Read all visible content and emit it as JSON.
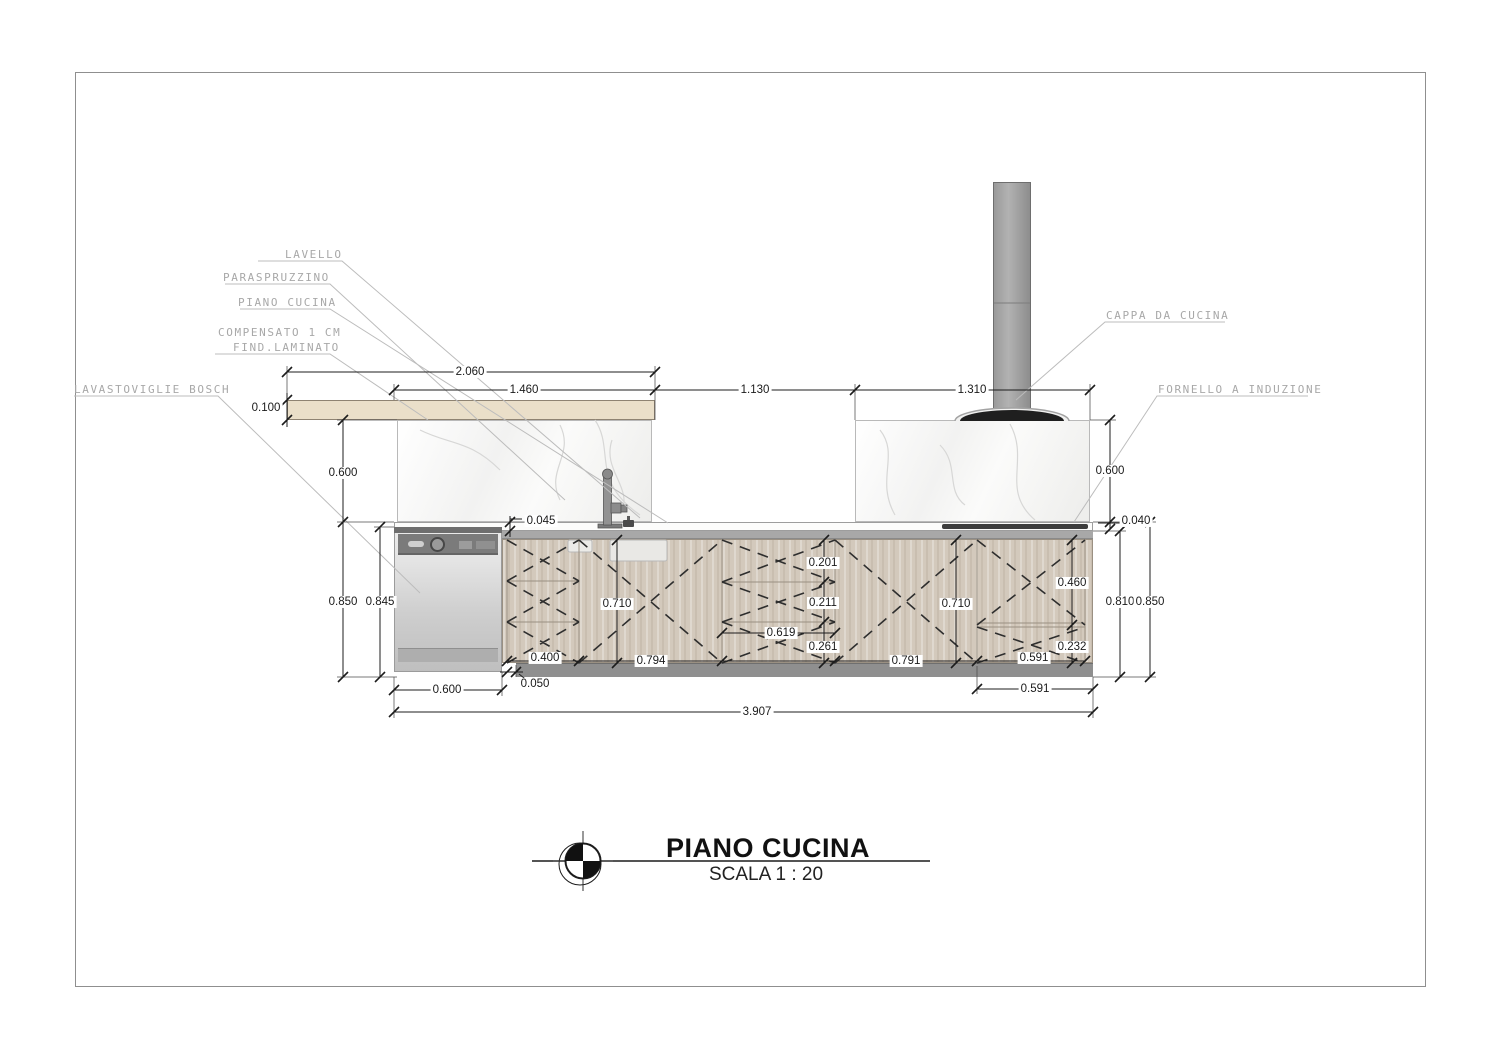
{
  "title_block": {
    "title": "PIANO CUCINA",
    "scale": "SCALA 1 : 20"
  },
  "callouts": {
    "lavello": "LAVELLO",
    "paraspruzzino": "PARASPRUZZINO",
    "piano_cucina": "PIANO CUCINA",
    "compensato_line1": "COMPENSATO 1 CM",
    "compensato_line2": "FIND.LAMINATO",
    "lavastoviglie": "LAVASTOVIGLIE BOSCH",
    "cappa": "CAPPA DA CUCINA",
    "fornello": "FORNELLO A INDUZIONE"
  },
  "dimensions": {
    "top_shelf": "2.060",
    "top_splash_left": "1.460",
    "top_gap": "1.130",
    "top_splash_right": "1.310",
    "shelf_thickness": "0.100",
    "splash_height_left": "0.600",
    "cabinet_height_left": "0.850",
    "dishwasher_height": "0.845",
    "counter_thickness_left": "0.045",
    "door_height_left": "0.710",
    "drawer1_height": "0.201",
    "drawer2_height": "0.211",
    "drawer_stack_width": "0.619",
    "drawer3_height": "0.261",
    "door_height_right": "0.710",
    "door_upper_right": "0.460",
    "drawer_lower_right": "0.232",
    "inner_height_right": "0.810",
    "cabinet_height_right": "0.850",
    "splash_height_right": "0.600",
    "counter_thickness_right": "0.040",
    "unit1_width": "0.400",
    "unit2_width": "0.794",
    "unit4_width": "0.791",
    "unit5_width": "0.591",
    "plinth_inset": "0.050",
    "dishwasher_width": "0.600",
    "unit5_width_base": "0.591",
    "total_width": "3.907"
  },
  "colors": {
    "dim_line": "#1c1c1c",
    "callout_text": "#a8a8a8",
    "wood": "#d3c9bc",
    "hood": "#1f1f1f",
    "marble": "#f4f4f3"
  }
}
